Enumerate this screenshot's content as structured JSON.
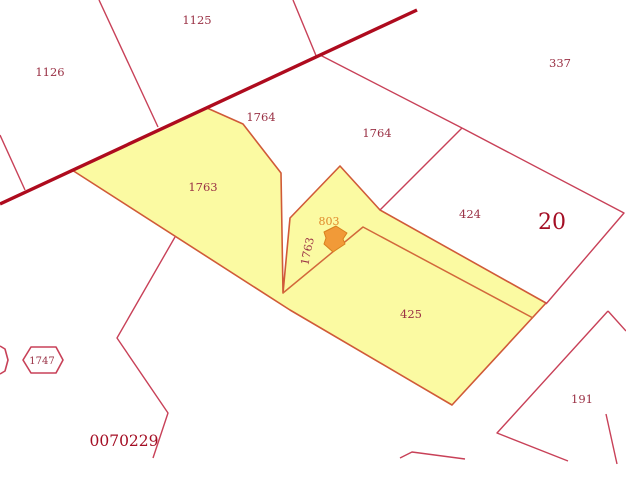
{
  "map": {
    "width": 626,
    "height": 481,
    "background": "#ffffff",
    "highlight_fill": "#fbfaa2",
    "highlight_stroke": "#d05a38",
    "inner_boundary_color": "#d2683b",
    "boundary_color": "#c84158",
    "road_color": "#ae0b1e",
    "road_width": 3.4,
    "label_color": "#9a3145",
    "big_label_color": "#a40e24",
    "marker_color": "#f19a38",
    "marker_stroke": "#d87f1e",
    "road": {
      "points": "0,204 417,10"
    },
    "highlight_polygon": {
      "points": "72,170 207,108 243,124 281,173 283,293 290,218 340,166 380,210 546,303 452,405 290,310"
    },
    "inner_boundaries": [
      {
        "name": "parcel-divider-1763-425",
        "points": "283,293 363,227 533,318"
      }
    ],
    "boundaries": [
      {
        "name": "boundary-left-sliver",
        "points": "0,135 25,190"
      },
      {
        "name": "boundary-1126-1125",
        "points": "99,0 158,127"
      },
      {
        "name": "boundary-1125-east",
        "points": "293,0 317,58"
      },
      {
        "name": "boundary-1764-337",
        "points": "320,55 462,128"
      },
      {
        "name": "boundary-1764-424",
        "points": "462,128 380,210"
      },
      {
        "name": "boundary-337-block20",
        "points": "462,128 624,213 546,304"
      },
      {
        "name": "boundary-southwest-zigzag",
        "points": "175,237 117,338 168,413 153,458"
      },
      {
        "name": "boundary-191-west",
        "points": "608,311 497,433 568,461"
      },
      {
        "name": "boundary-191-northeast",
        "points": "608,311 626,331"
      },
      {
        "name": "boundary-191-east",
        "points": "606,414 617,464"
      },
      {
        "name": "boundary-bottom-chevron",
        "points": "400,458 412,452 465,459"
      }
    ],
    "hexagons": [
      {
        "name": "hexagon-1747",
        "points": "23,360 31,347 56,347 63,360 56,373 31,373",
        "closed": true
      },
      {
        "name": "hexagon-left-partial",
        "points": "0,346 5,349 8,360 5,371 0,374",
        "closed": false
      }
    ],
    "marker": {
      "name": "selection-arrow-marker",
      "points": "324,232 336,226 347,233 343,239 345,244 333,252 324,244 326,238"
    },
    "labels": [
      {
        "name": "parcel-label-1125",
        "text": "1125",
        "x": 197,
        "y": 24,
        "size": 11.5,
        "color": "#9a3145",
        "rotate": 0
      },
      {
        "name": "parcel-label-1126",
        "text": "1126",
        "x": 50,
        "y": 76,
        "size": 11.5,
        "color": "#9a3145",
        "rotate": 0
      },
      {
        "name": "parcel-label-337",
        "text": "337",
        "x": 560,
        "y": 67,
        "size": 11.5,
        "color": "#9a3145",
        "rotate": 0
      },
      {
        "name": "parcel-label-1764-west",
        "text": "1764",
        "x": 261,
        "y": 121,
        "size": 11.5,
        "color": "#9a3145",
        "rotate": 0
      },
      {
        "name": "parcel-label-1764-east",
        "text": "1764",
        "x": 377,
        "y": 137,
        "size": 11.5,
        "color": "#9a3145",
        "rotate": 0
      },
      {
        "name": "parcel-label-1763",
        "text": "1763",
        "x": 203,
        "y": 191,
        "size": 11.5,
        "color": "#9a3145",
        "rotate": 0
      },
      {
        "name": "parcel-label-424",
        "text": "424",
        "x": 470,
        "y": 218,
        "size": 11.5,
        "color": "#9a3145",
        "rotate": 0
      },
      {
        "name": "block-label-20",
        "text": "20",
        "x": 552,
        "y": 229,
        "size": 22,
        "color": "#a40e24",
        "rotate": 0
      },
      {
        "name": "parcel-label-803",
        "text": "803",
        "x": 329,
        "y": 225,
        "size": 11,
        "color": "#e0892b",
        "rotate": 0
      },
      {
        "name": "parcel-label-1763-strip",
        "text": "1763",
        "x": 311,
        "y": 252,
        "size": 11,
        "color": "#9a3145",
        "rotate": -78
      },
      {
        "name": "parcel-label-425",
        "text": "425",
        "x": 411,
        "y": 318,
        "size": 11.5,
        "color": "#9a3145",
        "rotate": 0
      },
      {
        "name": "parcel-label-1747",
        "text": "1747",
        "x": 42,
        "y": 364,
        "size": 10,
        "color": "#9a3145",
        "rotate": 0
      },
      {
        "name": "parcel-label-191",
        "text": "191",
        "x": 582,
        "y": 403,
        "size": 11.5,
        "color": "#9a3145",
        "rotate": 0
      },
      {
        "name": "sheet-label",
        "text": "0070229",
        "x": 124,
        "y": 446,
        "size": 15.5,
        "color": "#a40e24",
        "rotate": 0
      }
    ]
  }
}
